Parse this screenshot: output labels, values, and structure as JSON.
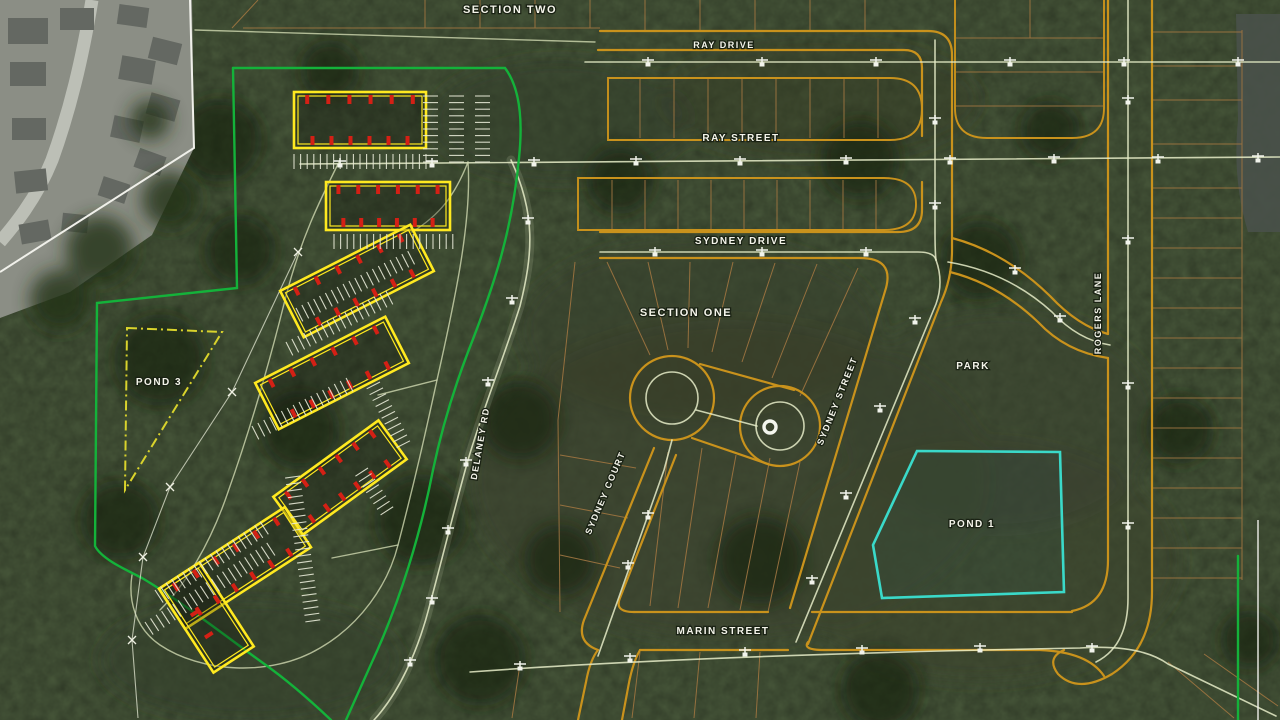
{
  "map": {
    "kind": "aerial-site-plan-overlay",
    "labels": {
      "section_two": "SECTION TWO",
      "section_one": "SECTION ONE",
      "ray_drive": "RAY DRIVE",
      "ray_street": "RAY STREET",
      "sydney_drive": "SYDNEY DRIVE",
      "sydney_court": "SYDNEY COURT",
      "sydney_street": "SYDNEY STREET",
      "marin_street": "MARIN STREET",
      "rogers_lane": "ROGERS LANE",
      "delaney_rd": "DELANEY RD",
      "park": "PARK",
      "pond_1": "POND 1",
      "pond_3": "POND 3"
    },
    "streets": [
      "RAY DRIVE",
      "RAY STREET",
      "SYDNEY DRIVE",
      "SYDNEY COURT",
      "SYDNEY STREET",
      "MARIN STREET",
      "ROGERS LANE",
      "DELANEY RD"
    ],
    "sections": [
      "SECTION ONE",
      "SECTION TWO"
    ],
    "areas": [
      "PARK",
      "POND 1",
      "POND 3"
    ],
    "colors": {
      "road_outline": "#c9921c",
      "lot_line": "#9b7340",
      "building_outline": "#ffe920",
      "unit_marker": "#d42015",
      "site_boundary_green": "#14b23a",
      "pond1_outline": "#3ad9c9",
      "pond3_outline": "#d9d32c",
      "existing_centerline": "#e6ecc8",
      "label_text": "#f4f4ea"
    }
  }
}
